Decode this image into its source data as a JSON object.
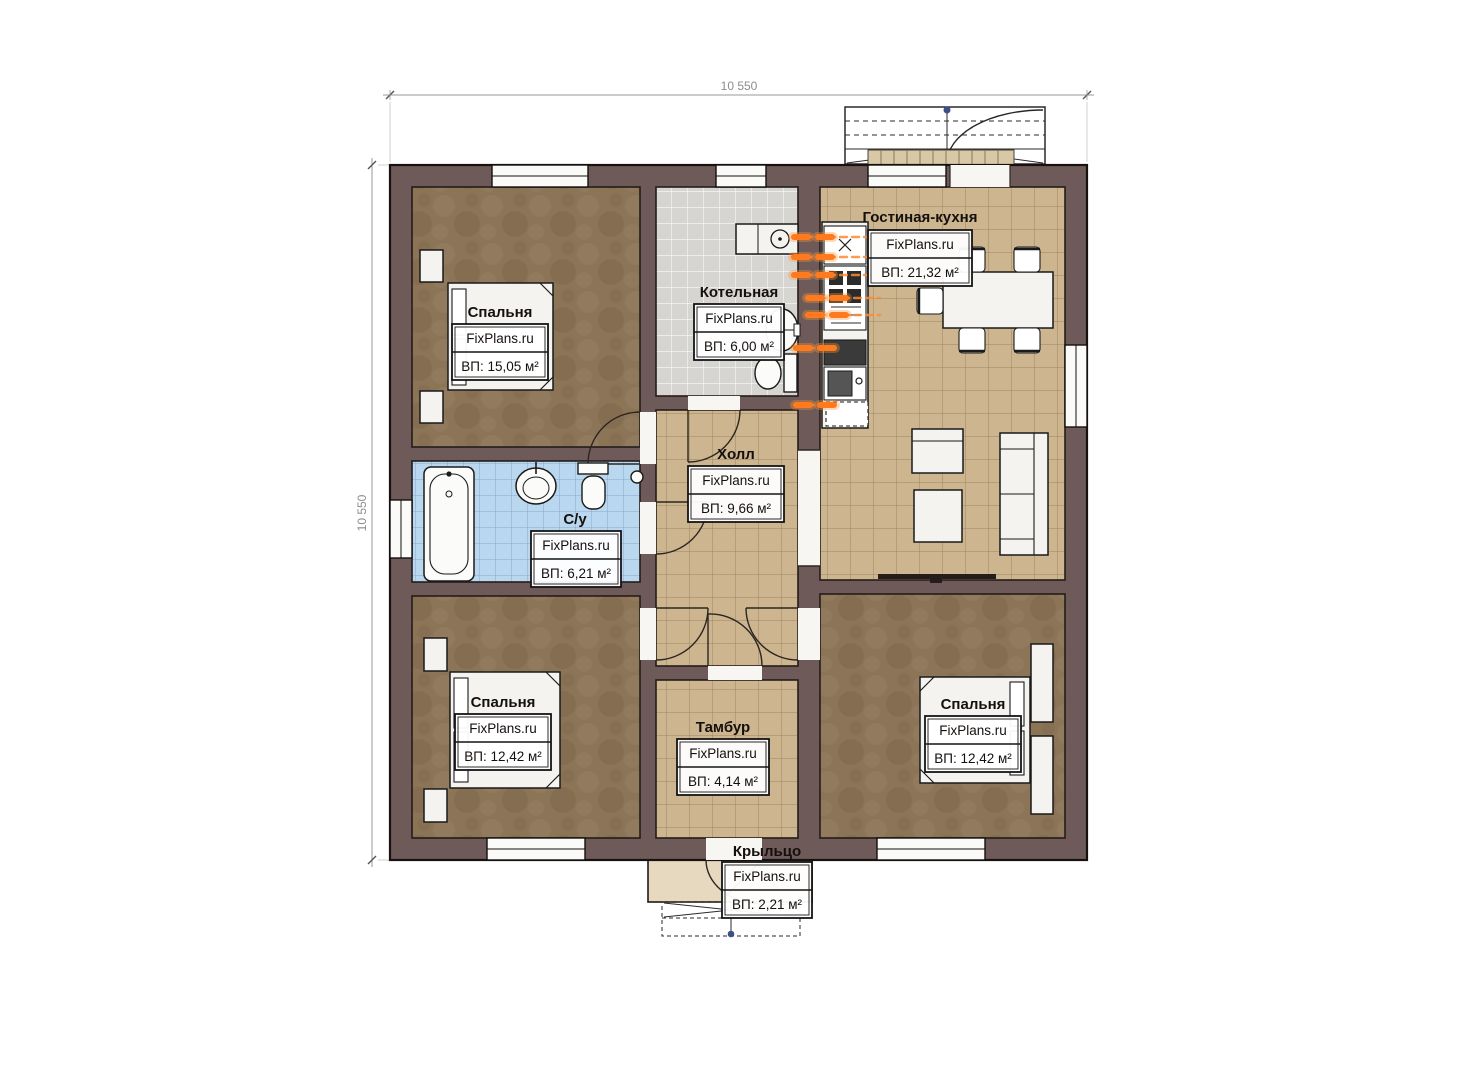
{
  "plan": {
    "top_dimension": "10 550",
    "left_dimension": "10 550"
  },
  "rooms": [
    {
      "id": "bedroom-top-left",
      "name": "Спальня",
      "watermark": "FixPlans.ru",
      "area": "ВП: 15,05 м²"
    },
    {
      "id": "boiler-room",
      "name": "Котельная",
      "watermark": "FixPlans.ru",
      "area": "ВП: 6,00 м²"
    },
    {
      "id": "living-kitchen",
      "name": "Гостиная-кухня",
      "watermark": "FixPlans.ru",
      "area": "ВП: 21,32 м²"
    },
    {
      "id": "hall",
      "name": "Холл",
      "watermark": "FixPlans.ru",
      "area": "ВП: 9,66 м²"
    },
    {
      "id": "bathroom",
      "name": "С/у",
      "watermark": "FixPlans.ru",
      "area": "ВП: 6,21 м²"
    },
    {
      "id": "bedroom-bottom-left",
      "name": "Спальня",
      "watermark": "FixPlans.ru",
      "area": "ВП: 12,42 м²"
    },
    {
      "id": "vestibule",
      "name": "Тамбур",
      "watermark": "FixPlans.ru",
      "area": "ВП: 4,14 м²"
    },
    {
      "id": "bedroom-bottom-right",
      "name": "Спальня",
      "watermark": "FixPlans.ru",
      "area": "ВП: 12,42 м²"
    },
    {
      "id": "porch",
      "name": "Крыльцо",
      "watermark": "FixPlans.ru",
      "area": "ВП: 2,21 м²"
    }
  ],
  "colors": {
    "wall": "#6e5a59",
    "bedroom_floor": "#8c7456",
    "tile_floor": "#cdb58f",
    "bathroom_floor": "#b9d8ef",
    "boiler_floor": "#d7d5d2",
    "porch_floor": "#e6d9bf",
    "heating_pipes": "#ff7a1f",
    "dimension": "#8c8c8c"
  }
}
